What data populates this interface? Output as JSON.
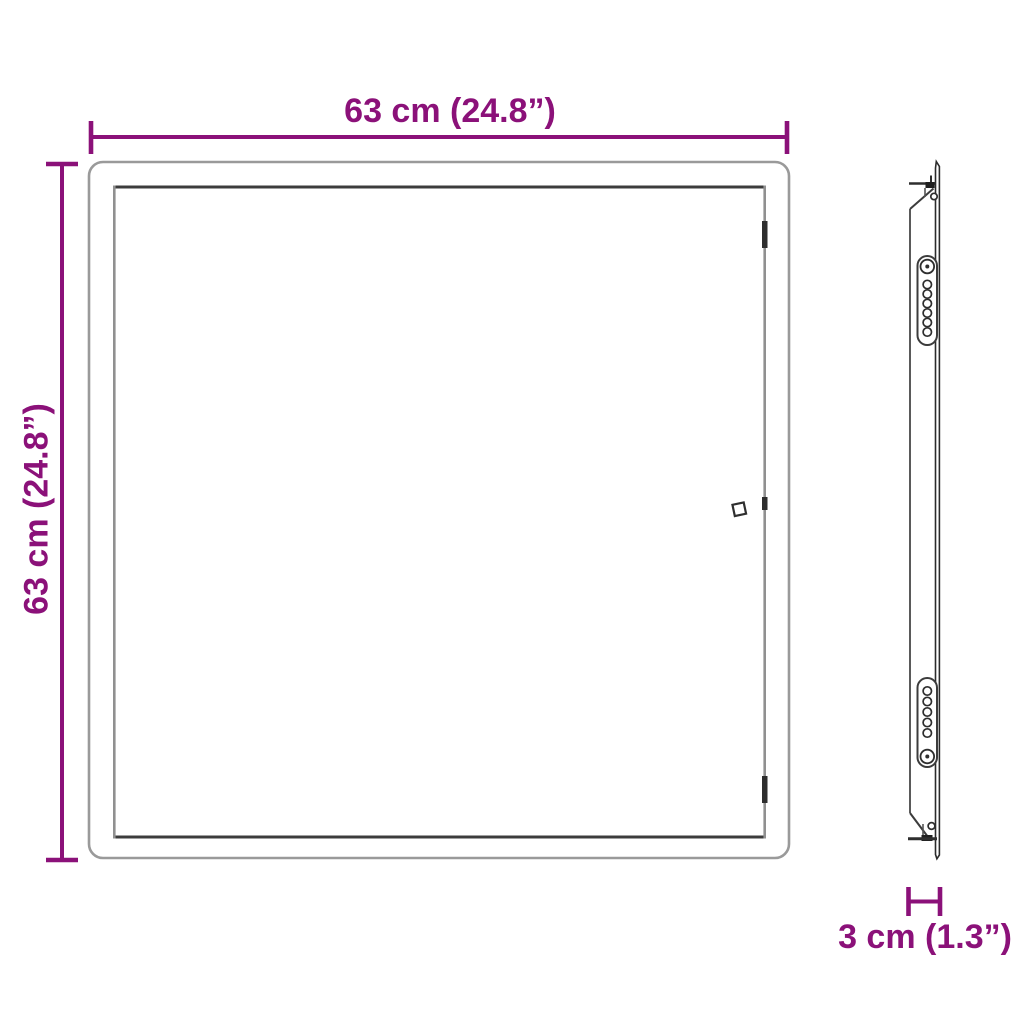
{
  "page": {
    "type": "product-dimension-diagram",
    "background": "#FFFFFF"
  },
  "labels": {
    "width": "63 cm (24.8”)",
    "height": "63 cm (24.8”)",
    "depth": "3 cm (1.3”)"
  },
  "dimensions": {
    "width": {
      "cm": 63,
      "inches": 24.8
    },
    "height": {
      "cm": 63,
      "inches": 24.8
    },
    "depth": {
      "cm": 3,
      "inches": 1.3
    }
  },
  "colors": {
    "dimension_accent": "#8B1179",
    "frame_outer_gray": "#9A9A9A",
    "frame_inner_dark": "#3C3C3C",
    "frame_inner_gray": "#909090",
    "detail_dark": "#2E2E2E",
    "background": "#FFFFFF"
  },
  "views": {
    "front": {
      "name": "front-view"
    },
    "side": {
      "name": "side-view"
    }
  }
}
